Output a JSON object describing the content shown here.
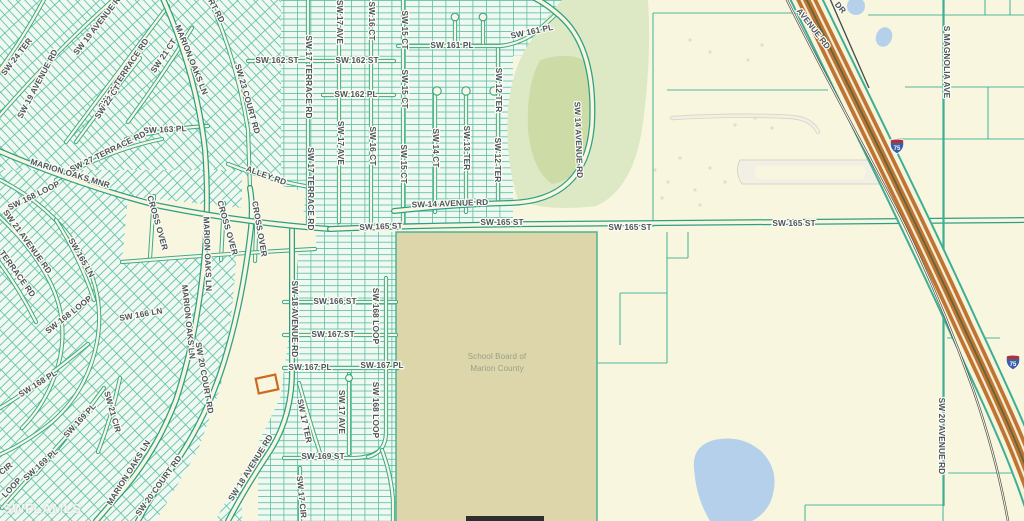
{
  "map": {
    "watermark": "SWFLAMLS",
    "school_parcel": {
      "line1": "School Board of",
      "line2": "Marion County"
    },
    "highway_shields": [
      {
        "label": "75",
        "x": 897,
        "y": 146
      },
      {
        "label": "75",
        "x": 1013,
        "y": 362
      }
    ],
    "colors": {
      "land": "#f8f6df",
      "residential_fill": "#f0f9f1",
      "parcel_line": "#5cc0a3",
      "road_casing": "#35a88c",
      "park": "#dde9c5",
      "park_inner": "#cddca6",
      "school_parcel": "#ddd6ab",
      "water": "#b5d0eb",
      "highway_orange": "#bf7434",
      "highlight_parcel": "#cc6a22",
      "label_text": "#4a5460"
    },
    "labels": [
      {
        "t": "SW 24 TER",
        "x": 17,
        "y": 57,
        "r": -52
      },
      {
        "t": "SW 19 AVENUE RD",
        "x": 38,
        "y": 84,
        "r": -62
      },
      {
        "t": "SW 19 AVENUE RD",
        "x": 99,
        "y": 24,
        "r": -52
      },
      {
        "t": "SW 21 TERRACE RD",
        "x": 124,
        "y": 74,
        "r": -56
      },
      {
        "t": "SW 21 CT",
        "x": 164,
        "y": 56,
        "r": -56
      },
      {
        "t": "SW 22 CT",
        "x": 108,
        "y": 102,
        "r": -56
      },
      {
        "t": "SW 163 PL",
        "x": 165,
        "y": 130,
        "r": -3
      },
      {
        "t": "SW 27 TERRACE RD",
        "x": 108,
        "y": 152,
        "r": -26
      },
      {
        "t": "MARION OAKS LN",
        "x": 191,
        "y": 60,
        "r": 68
      },
      {
        "t": "RT RD",
        "x": 216,
        "y": 11,
        "r": 62
      },
      {
        "t": "SW 23 COURT RD",
        "x": 247,
        "y": 99,
        "r": 74
      },
      {
        "t": "ALLEY RD",
        "x": 266,
        "y": 176,
        "r": 20
      },
      {
        "t": "MARION OAKS MNR",
        "x": 70,
        "y": 174,
        "r": 17
      },
      {
        "t": "SW 162 ST",
        "x": 277,
        "y": 61,
        "r": 0
      },
      {
        "t": "SW 17 TERRACE RD",
        "x": 308,
        "y": 77,
        "r": 90
      },
      {
        "t": "SW 17 TERRACE RD",
        "x": 310,
        "y": 189,
        "r": 90
      },
      {
        "t": "CROSS OVER",
        "x": 157,
        "y": 223,
        "r": 74
      },
      {
        "t": "CROSS OVER",
        "x": 227,
        "y": 228,
        "r": 74
      },
      {
        "t": "CROSS OVER",
        "x": 259,
        "y": 229,
        "r": 80
      },
      {
        "t": "MARION OAKS LN",
        "x": 207,
        "y": 254,
        "r": 88
      },
      {
        "t": "MARION OAKS LN",
        "x": 188,
        "y": 322,
        "r": 84
      },
      {
        "t": "SW 168 LOOP",
        "x": 34,
        "y": 196,
        "r": -26
      },
      {
        "t": "SW 21 AVENUE RD",
        "x": 27,
        "y": 242,
        "r": 54
      },
      {
        "t": "SW 165 LN",
        "x": 81,
        "y": 258,
        "r": 60
      },
      {
        "t": "TERRACE RD",
        "x": 17,
        "y": 274,
        "r": 54
      },
      {
        "t": "SW 168 LOOP",
        "x": 69,
        "y": 315,
        "r": -38
      },
      {
        "t": "SW 166 LN",
        "x": 141,
        "y": 315,
        "r": -10
      },
      {
        "t": "SW 168 PL",
        "x": 38,
        "y": 384,
        "r": -32
      },
      {
        "t": "SW 169 PL",
        "x": 80,
        "y": 421,
        "r": -47
      },
      {
        "t": "SW 169 PL",
        "x": 41,
        "y": 465,
        "r": -42
      },
      {
        "t": "SW 21 CIR",
        "x": 112,
        "y": 412,
        "r": 74
      },
      {
        "t": "SW 20 COURT RD",
        "x": 204,
        "y": 378,
        "r": 80
      },
      {
        "t": "SW 20 COURT RD",
        "x": 159,
        "y": 486,
        "r": -54
      },
      {
        "t": "MARION OAKS LN",
        "x": 129,
        "y": 473,
        "r": -58
      },
      {
        "t": "SW 18 AVENUE RD",
        "x": 251,
        "y": 468,
        "r": -58
      },
      {
        "t": "CIR",
        "x": 6,
        "y": 469,
        "r": -38
      },
      {
        "t": "LOOP",
        "x": 12,
        "y": 488,
        "r": -46
      },
      {
        "t": "SW 17 AVE",
        "x": 339,
        "y": 22,
        "r": 90
      },
      {
        "t": "SW 16 CT",
        "x": 371,
        "y": 21,
        "r": 90
      },
      {
        "t": "SW 15 CT",
        "x": 404,
        "y": 30,
        "r": 90
      },
      {
        "t": "SW 15 CT",
        "x": 404,
        "y": 89,
        "r": 90
      },
      {
        "t": "SW 15 CT",
        "x": 403,
        "y": 164,
        "r": 90
      },
      {
        "t": "SW 161 PL",
        "x": 452,
        "y": 46,
        "r": 0
      },
      {
        "t": "SW 161 PL",
        "x": 532,
        "y": 32,
        "r": -12
      },
      {
        "t": "SW 162 ST",
        "x": 357,
        "y": 61,
        "r": 0
      },
      {
        "t": "SW 162 PL",
        "x": 356,
        "y": 95,
        "r": 0
      },
      {
        "t": "SW 17 AVE",
        "x": 340,
        "y": 143,
        "r": 90
      },
      {
        "t": "SW 16 CT",
        "x": 372,
        "y": 146,
        "r": 90
      },
      {
        "t": "SW 14 CT",
        "x": 435,
        "y": 148,
        "r": 90
      },
      {
        "t": "SW 13 TER",
        "x": 466,
        "y": 148,
        "r": 90
      },
      {
        "t": "SW 12 TER",
        "x": 498,
        "y": 90,
        "r": 90
      },
      {
        "t": "SW 12 TER",
        "x": 497,
        "y": 160,
        "r": 90
      },
      {
        "t": "SW 14 AVENUE RD",
        "x": 578,
        "y": 140,
        "r": 88
      },
      {
        "t": "SW 14 AVENUE RD",
        "x": 450,
        "y": 204,
        "r": -2
      },
      {
        "t": "SW 165 ST",
        "x": 381,
        "y": 227,
        "r": -2
      },
      {
        "t": "SW 165 ST",
        "x": 502,
        "y": 223,
        "r": 0
      },
      {
        "t": "SW 165 ST",
        "x": 630,
        "y": 228,
        "r": 0
      },
      {
        "t": "SW 165 ST",
        "x": 794,
        "y": 224,
        "r": 0
      },
      {
        "t": "SW 18 AVENUE RD",
        "x": 294,
        "y": 319,
        "r": 90
      },
      {
        "t": "SW 166 ST",
        "x": 335,
        "y": 302,
        "r": 0
      },
      {
        "t": "SW 167 ST",
        "x": 333,
        "y": 335,
        "r": 0
      },
      {
        "t": "SW 167 PL",
        "x": 310,
        "y": 368,
        "r": 0
      },
      {
        "t": "SW 167 PL",
        "x": 382,
        "y": 366,
        "r": 0
      },
      {
        "t": "SW 168 LOOP",
        "x": 375,
        "y": 316,
        "r": 90
      },
      {
        "t": "SW 168 LOOP",
        "x": 375,
        "y": 410,
        "r": 90
      },
      {
        "t": "SW 17 TER",
        "x": 304,
        "y": 421,
        "r": 78
      },
      {
        "t": "SW 17 AVE",
        "x": 341,
        "y": 412,
        "r": 90
      },
      {
        "t": "SW 169 ST",
        "x": 323,
        "y": 457,
        "r": 0
      },
      {
        "t": "SW 17 CIR",
        "x": 301,
        "y": 497,
        "r": 84
      },
      {
        "t": "S MAGNOLIA AVE",
        "x": 946,
        "y": 62,
        "r": 90
      },
      {
        "t": "SW 20 AVENUE RD",
        "x": 941,
        "y": 436,
        "r": 90
      },
      {
        "t": "AVENUE RD",
        "x": 813,
        "y": 29,
        "r": 52
      },
      {
        "t": "DR",
        "x": 840,
        "y": 8,
        "r": 50
      },
      {
        "t": "School Board of",
        "x": 497,
        "y": 357,
        "r": 0,
        "c": "area"
      },
      {
        "t": "Marion County",
        "x": 497,
        "y": 369,
        "r": 0,
        "c": "area"
      }
    ]
  }
}
